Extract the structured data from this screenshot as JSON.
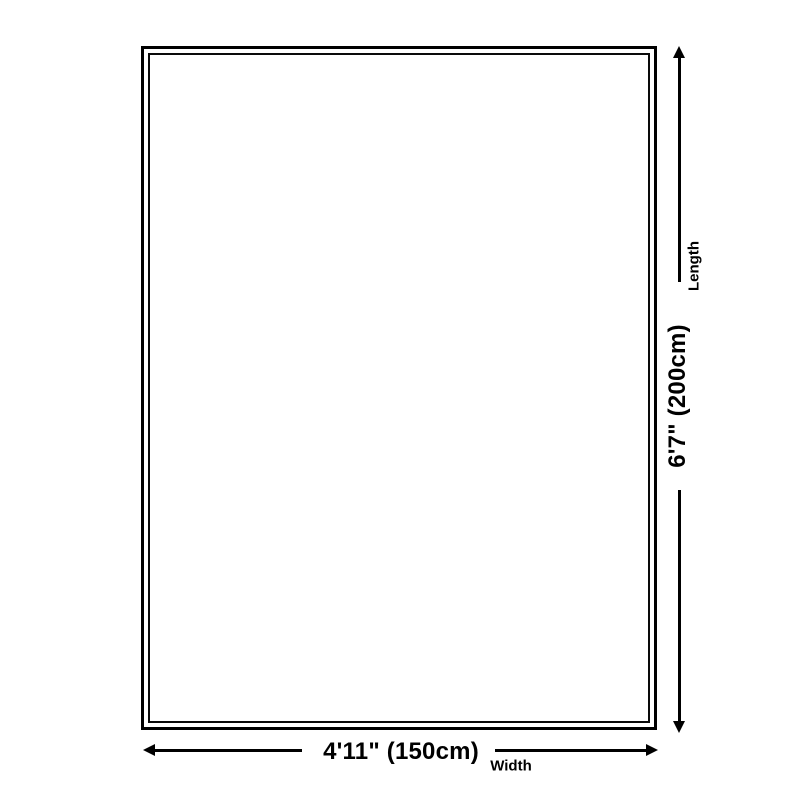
{
  "diagram": {
    "title": "Product size diagram",
    "shape": "rectangle outline with double border"
  },
  "colors": {
    "line": "#000000",
    "background": "#ffffff",
    "text": "#000000"
  },
  "dimensions": {
    "length": {
      "value": "6'7\" (200cm)",
      "axis": "Length"
    },
    "width": {
      "value": "4'11\" (150cm)",
      "axis": "Width"
    }
  },
  "icons": {
    "arrow_up": "css-triangle-up",
    "arrow_down": "css-triangle-down",
    "arrow_left": "css-triangle-left",
    "arrow_right": "css-triangle-right"
  }
}
